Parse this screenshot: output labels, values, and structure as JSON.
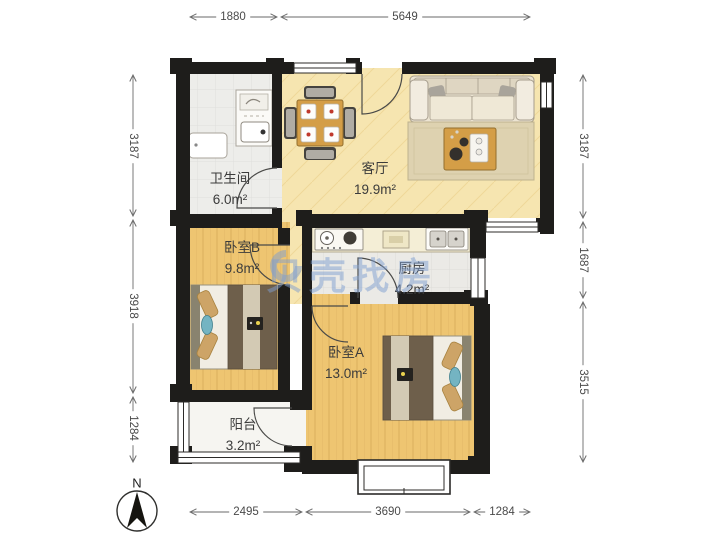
{
  "rooms": [
    {
      "name": "卫生间",
      "area": "6.0m²"
    },
    {
      "name": "客厅",
      "area": "19.9m²"
    },
    {
      "name": "卧室B",
      "area": "9.8m²"
    },
    {
      "name": "厨房",
      "area": "4.2m²"
    },
    {
      "name": "卧室A",
      "area": "13.0m²"
    },
    {
      "name": "阳台",
      "area": "3.2m²"
    }
  ],
  "dimensions": {
    "top": [
      "1880",
      "5649"
    ],
    "left": [
      "3187",
      "3918",
      "1284"
    ],
    "right": [
      "3187",
      "1687",
      "3515"
    ],
    "bottom": [
      "2495",
      "3690",
      "1284"
    ]
  },
  "compass": {
    "north_label": "N"
  },
  "watermark": {
    "text": "贝壳找房"
  },
  "colors": {
    "wall": "#1e1d1b",
    "wood_floor": "#eec571",
    "marble_floor": "#f6e5b0",
    "tile_floor": "#ededea",
    "balcony_floor": "#f6f5f1",
    "watermark_blue": "#8fb0da",
    "dimension_line": "#6a6a6a"
  }
}
